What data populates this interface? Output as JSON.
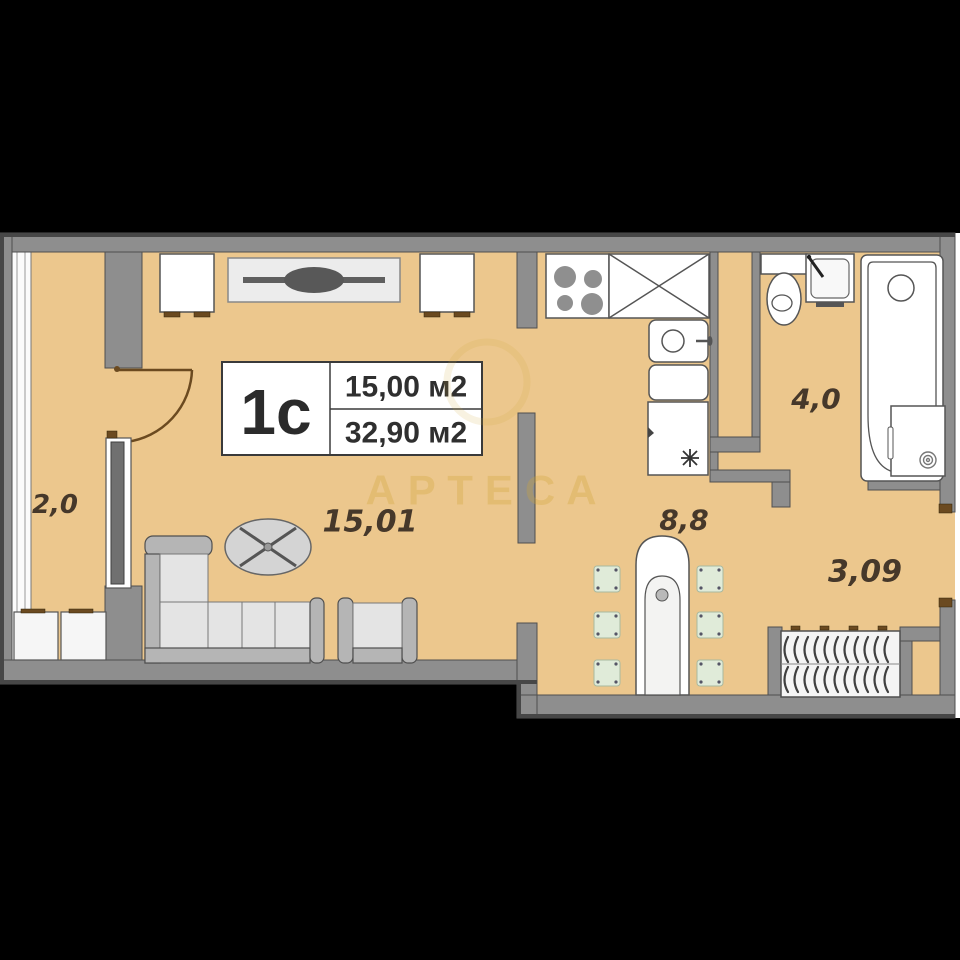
{
  "plan": {
    "title_block": {
      "unit": "1с",
      "area_living": "15,00 м2",
      "area_total": "32,90 м2"
    },
    "room_labels": {
      "balcony": "2,0",
      "living": "15,01",
      "kitchen": "8,8",
      "bathroom": "4,0",
      "hallway": "3,09"
    },
    "watermark": "АРТЕСА",
    "colors": {
      "background": "#000000",
      "floor": "#ecc78d",
      "wall": "#8e8e8e",
      "wall_edge": "#474747",
      "label_text": "#46382a",
      "door": "#6b4a20",
      "watermark": "#d0a537"
    }
  }
}
